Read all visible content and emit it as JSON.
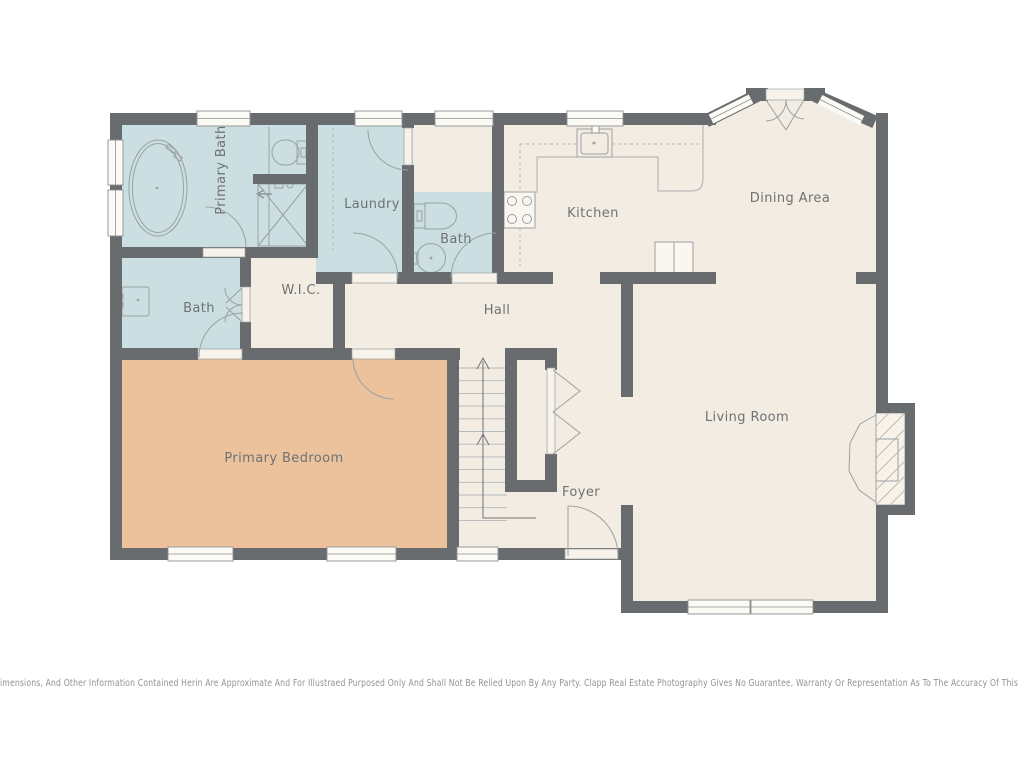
{
  "rooms": {
    "primary_bath": "Primary Bath",
    "laundry": "Laundry",
    "bath_upper": "Bath",
    "kitchen": "Kitchen",
    "dining": "Dining Area",
    "bath_left": "Bath",
    "wic": "W.I.C.",
    "hall": "Hall",
    "primary_bedroom": "Primary Bedroom",
    "foyer": "Foyer",
    "living": "Living Room"
  },
  "disclaimer": "imensions, And Other Information Contained Herin Are Approximate And For Illustraed Purposed Only And Shall Not Be Relied Upon By Any Party. Clapp Real Estate Photography Gives No Guarantee, Warranty Or Representation As To The Accuracy Of This",
  "colors": {
    "wall": "#686c6e",
    "bathroom_fill": "#cbdee1",
    "floor_fill": "#f3ece2",
    "bedroom_fill": "#ebc29c",
    "label": "#6e7274",
    "disclaimer": "#8f9294"
  }
}
